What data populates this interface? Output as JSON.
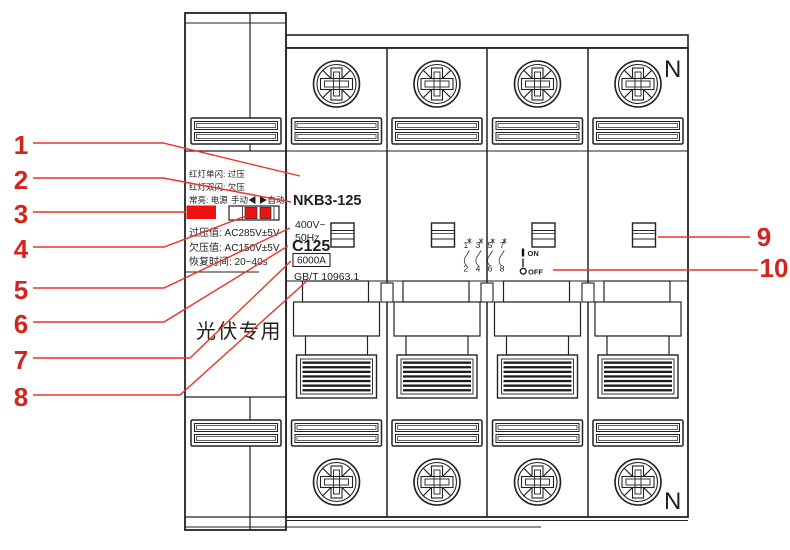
{
  "figure": {
    "type": "circuit-breaker-diagram",
    "product": {
      "model": "NKB3-125",
      "voltage": "400V~",
      "frequency": "50Hz",
      "curve_rating": "C125",
      "breaking_capacity": "6000A",
      "standard": "GB/T 10963.1",
      "application": "光伏专用",
      "neutral_marking": "N"
    },
    "indicator_panel": {
      "red_single_flash": "红灯单闪: 过压",
      "red_double_flash": "红灯双闪: 欠压",
      "steady_on": "常亮: 电源",
      "mode_switch": "手动◀ ▶自动",
      "overvoltage_value": "过压值: AC285V±5V",
      "undervoltage_value": "欠压值: AC150V±5V",
      "recovery_time": "恢复时间: 20~40s"
    },
    "switch_markings": {
      "on_symbol": "I",
      "on": "ON",
      "off_symbol": "O",
      "off": "OFF"
    },
    "wiring_diagram": {
      "top_terminals": "1 3 5 7",
      "bottom_terminals": "2 4 6 8"
    },
    "callouts": [
      "1",
      "2",
      "3",
      "4",
      "5",
      "6",
      "7",
      "8",
      "9",
      "10"
    ],
    "colors": {
      "callout_red": "#d1251d",
      "leader_line_red": "#ee3226",
      "led_red": "#ec1212",
      "drawing_line": "#222222"
    }
  }
}
